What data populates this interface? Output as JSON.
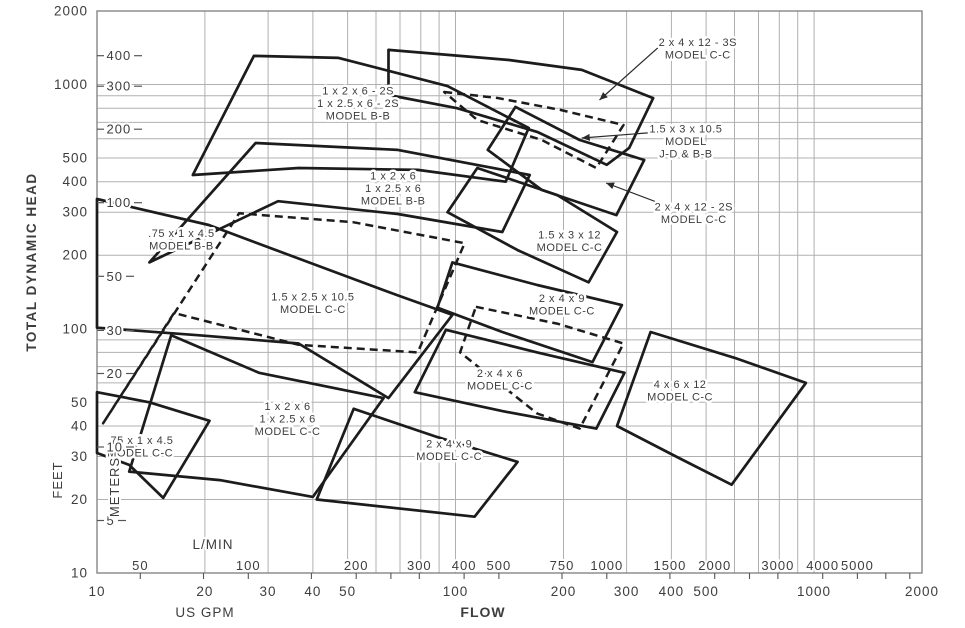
{
  "chart_data": {
    "type": "area",
    "title": "Pump model selection chart: FLOW vs TOTAL DYNAMIC HEAD",
    "colors": {
      "line": "#1c1c1c",
      "grid": "#b0b0b0",
      "border": "#7d7d7d",
      "text": "#3d3d3d"
    },
    "y_axis": {
      "title": "TOTAL DYNAMIC HEAD",
      "primary_name": "FEET",
      "primary_range": [
        10,
        2000
      ],
      "primary_labeled_ticks": [
        10,
        20,
        30,
        40,
        50,
        100,
        200,
        300,
        400,
        500,
        1000,
        2000
      ],
      "secondary_name": "METERS",
      "secondary_labeled_ticks": [
        5,
        10,
        20,
        30,
        50,
        100,
        200,
        300,
        400
      ]
    },
    "x_axis": {
      "title": "FLOW",
      "primary_name": "US GPM",
      "primary_range": [
        10,
        2000
      ],
      "primary_labeled_ticks": [
        10,
        20,
        30,
        40,
        50,
        100,
        200,
        300,
        400,
        500,
        1000,
        2000
      ],
      "secondary_name": "L/MIN",
      "secondary_labeled_ticks": [
        50,
        100,
        200,
        300,
        400,
        500,
        750,
        1000,
        1500,
        2000,
        3000,
        4000,
        5000
      ],
      "secondary_minor_ticks": [
        50,
        75,
        100,
        150,
        200,
        250,
        300,
        400,
        500,
        750,
        1000,
        1500,
        2000,
        2500,
        3000,
        4000,
        5000,
        6000,
        7000
      ]
    },
    "grid": {
      "log_decades_x": [
        10,
        100,
        1000
      ],
      "log_decades_y": [
        10,
        100,
        1000
      ],
      "max": 2000
    },
    "envelopes": [
      {
        "name": "envelope-075x1x45-bb",
        "style": "dashed",
        "label_lines": [
          ".75 x 1 x 4.5",
          "MODEL B-B"
        ],
        "label_at": [
          17.2,
          233
        ],
        "points": [
          [
            10.4,
            41
          ],
          [
            24.9,
            297
          ],
          [
            51.8,
            273
          ],
          [
            106,
            224
          ],
          [
            78.5,
            80
          ],
          [
            36.5,
            86
          ],
          [
            16.4,
            116
          ]
        ]
      },
      {
        "name": "envelope-075x1x45-cc",
        "style": "solid",
        "label_lines": [
          ".75 x 1 x 4.5",
          "MODEL C-C"
        ],
        "label_at": [
          13.2,
          33
        ],
        "points": [
          [
            10,
            55
          ],
          [
            14,
            50
          ],
          [
            20.6,
            42
          ],
          [
            15.3,
            20.3
          ],
          [
            12.3,
            27.7
          ],
          [
            10,
            31
          ]
        ]
      },
      {
        "name": "envelope-1x2x6-2s-bb",
        "style": "solid",
        "label_lines": [
          "1 x 2 x 6 - 2S",
          "1 x 2.5 x 6 - 2S",
          "MODEL B-B"
        ],
        "label_at": [
          53.5,
          840
        ],
        "points": [
          [
            18.5,
            426
          ],
          [
            27.4,
            1310
          ],
          [
            47.2,
            1285
          ],
          [
            95,
            985
          ],
          [
            160,
            664
          ],
          [
            138,
            400
          ],
          [
            78.5,
            447
          ],
          [
            36.5,
            455
          ]
        ]
      },
      {
        "name": "envelope-1x2x6-bb",
        "style": "solid",
        "label_lines": [
          "1 x 2 x 6",
          "1 x 2.5 x 6",
          "MODEL B-B"
        ],
        "label_at": [
          67,
          377
        ],
        "points": [
          [
            14,
            187
          ],
          [
            27.7,
            576
          ],
          [
            69,
            540
          ],
          [
            161,
            426
          ],
          [
            135,
            249
          ],
          [
            69,
            295
          ],
          [
            32,
            333
          ]
        ]
      },
      {
        "name": "envelope-15x25x105-cc",
        "style": "solid",
        "label_lines": [
          "1.5 x 2.5 x 10.5",
          "MODEL C-C"
        ],
        "label_at": [
          40,
          128
        ],
        "points": [
          [
            10,
            340
          ],
          [
            20.5,
            266
          ],
          [
            39,
            187
          ],
          [
            69,
            137
          ],
          [
            98,
            114
          ],
          [
            65,
            52
          ],
          [
            36.5,
            87
          ],
          [
            19.3,
            94
          ],
          [
            10,
            101
          ]
        ]
      },
      {
        "name": "envelope-1x2x6-cc",
        "style": "solid",
        "label_lines": [
          "1 x 2 x 6",
          "1 x 2.5 x 6",
          "MODEL C-C"
        ],
        "label_at": [
          34,
          43
        ],
        "points": [
          [
            12.3,
            26
          ],
          [
            16.1,
            94
          ],
          [
            28.3,
            66
          ],
          [
            63,
            52
          ],
          [
            40,
            20.5
          ],
          [
            22,
            24
          ]
        ]
      },
      {
        "name": "envelope-15x3x12-cc",
        "style": "solid",
        "label_lines": [
          "1.5 x 3 x 12",
          "MODEL C-C"
        ],
        "label_at": [
          208,
          229
        ],
        "points": [
          [
            95,
            300
          ],
          [
            115,
            455
          ],
          [
            192,
            353
          ],
          [
            282,
            249
          ],
          [
            235,
            155
          ],
          [
            149,
            210
          ]
        ]
      },
      {
        "name": "envelope-2x4x9-cc-upper",
        "style": "solid",
        "label_lines": [
          "2 x 4 x 9",
          "MODEL C-C"
        ],
        "label_at": [
          198,
          126
        ],
        "points": [
          [
            98,
            187
          ],
          [
            169,
            151
          ],
          [
            291,
            125
          ],
          [
            241,
            73
          ],
          [
            135,
            97
          ],
          [
            89,
            122
          ]
        ]
      },
      {
        "name": "envelope-2x4x9-dashed",
        "style": "dashed",
        "label_lines": [],
        "label_at": null,
        "points": [
          [
            114,
            123
          ],
          [
            192,
            105
          ],
          [
            294,
            87
          ],
          [
            222,
            39
          ],
          [
            169,
            45
          ],
          [
            103,
            80
          ]
        ]
      },
      {
        "name": "envelope-2x4x6-cc",
        "style": "solid",
        "label_lines": [
          "2 x 4 x 6",
          "MODEL C-C"
        ],
        "label_at": [
          133,
          62
        ],
        "points": [
          [
            77,
            55
          ],
          [
            94,
            99
          ],
          [
            169,
            80
          ],
          [
            296,
            66
          ],
          [
            247,
            39
          ],
          [
            135,
            46
          ]
        ]
      },
      {
        "name": "envelope-2x4x9-cc-lower",
        "style": "solid",
        "label_lines": [
          "2 x 4 x 9",
          "MODEL C-C"
        ],
        "label_at": [
          96,
          32
        ],
        "points": [
          [
            41,
            20
          ],
          [
            52,
            47
          ],
          [
            89,
            36
          ],
          [
            149,
            28.5
          ],
          [
            113,
            17
          ]
        ]
      },
      {
        "name": "envelope-4x6x12-cc",
        "style": "solid",
        "label_lines": [
          "4 x 6 x 12",
          "MODEL C-C"
        ],
        "label_at": [
          423,
          56
        ],
        "points": [
          [
            282,
            40
          ],
          [
            350,
            97
          ],
          [
            601,
            76
          ],
          [
            949,
            60
          ],
          [
            589,
            23
          ],
          [
            412,
            30
          ]
        ]
      },
      {
        "name": "envelope-2x4x12-3s-cc",
        "style": "solid",
        "label_lines": [],
        "label_at": null,
        "points": [
          [
            65,
            1386
          ],
          [
            141,
            1260
          ],
          [
            225,
            1148
          ],
          [
            356,
            880
          ],
          [
            305,
            550
          ],
          [
            264,
            469
          ],
          [
            169,
            640
          ],
          [
            101,
            800
          ],
          [
            65,
            906
          ]
        ]
      },
      {
        "name": "envelope-2x4x12-2s-cc",
        "style": "solid",
        "label_lines": [],
        "label_at": null,
        "points": [
          [
            123,
            540
          ],
          [
            147,
            810
          ],
          [
            222,
            593
          ],
          [
            336,
            491
          ],
          [
            281,
            292
          ],
          [
            174,
            370
          ]
        ]
      },
      {
        "name": "envelope-15x3x105-jd-bb",
        "style": "dashed",
        "label_lines": [],
        "label_at": null,
        "points": [
          [
            93,
            932
          ],
          [
            131,
            881
          ],
          [
            196,
            787
          ],
          [
            294,
            683
          ],
          [
            247,
            455
          ],
          [
            174,
            593
          ],
          [
            115,
            716
          ]
        ]
      }
    ],
    "callouts": [
      {
        "name": "callout-2x4x12-3s",
        "lines": [
          "2 x 4 x 12 - 3S",
          "MODEL C-C"
        ],
        "text_at": [
          474,
          1410
        ],
        "arrow": [
          [
            377,
            1466
          ],
          [
            252,
            864
          ]
        ]
      },
      {
        "name": "callout-15x3x105-jd",
        "lines": [
          "1.5 x 3 x 10.5",
          "MODEL",
          "J-D & B-B"
        ],
        "text_at": [
          439,
          587
        ],
        "arrow": [
          [
            370,
            639
          ],
          [
            225,
            604
          ]
        ]
      },
      {
        "name": "callout-2x4x12-2s",
        "lines": [
          "2 x 4 x 12 - 2S",
          "MODEL C-C"
        ],
        "text_at": [
          462,
          298
        ],
        "arrow": [
          [
            389,
            318
          ],
          [
            263,
            395
          ]
        ]
      }
    ]
  }
}
